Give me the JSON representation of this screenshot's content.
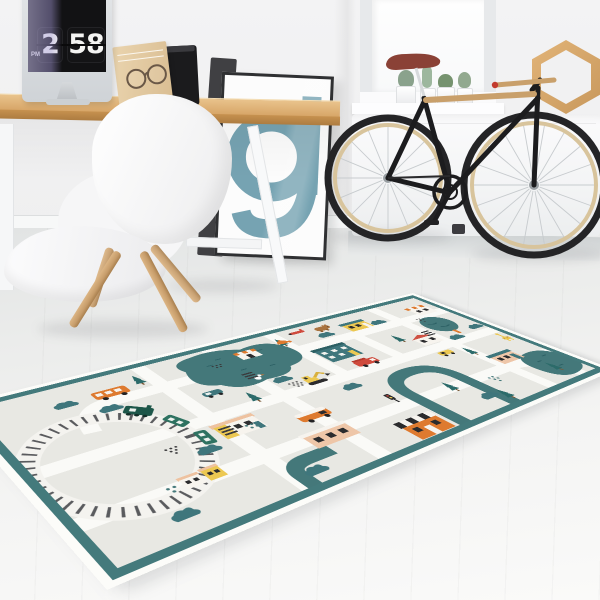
{
  "scene": {
    "title": "Bright scandinavian room with kids' town play rug",
    "description": "Product photo: play mat with city map design on light wood floor; desk with iMac flip-clock screensaver, white shell chair, framed letter poster, black bicycle by a radiator beneath a window, hexagon wall shelf."
  },
  "clock": {
    "hour": "2",
    "minute": "58",
    "meridiem": "PM"
  },
  "poster": {
    "letter": "g"
  },
  "palette": {
    "wall": "#f2f2f3",
    "floor_light": "#fafaf9",
    "floor_dark": "#e2e4e4",
    "desk_wood": "#d8a868",
    "chair_leg_wood": "#cfa472",
    "rug_border": "#447a7c",
    "rug_field": "#e8e8e3",
    "rug_road": "#fafaf7",
    "rug_teal": "#44787a",
    "rug_orange": "#de7a2f",
    "rug_yellow": "#ecc852",
    "rug_peach": "#eec6a8",
    "rug_red": "#cf4a3c",
    "rug_dark": "#2b2b2d",
    "bike_frame": "#1c1c1e",
    "bike_saddle": "#8a4136",
    "bike_rim": "#d8c49c",
    "screen_reflection": "#a79bd6",
    "poster_letter_color": "#76a3b2"
  },
  "rug_motifs": [
    "railway loop",
    "green train",
    "pond with duck",
    "road grid",
    "houses",
    "orange bus",
    "camper van",
    "fire truck",
    "excavator",
    "taxi",
    "biplane",
    "pine trees",
    "bushes",
    "bear",
    "fox",
    "giraffe",
    "dot clusters"
  ]
}
